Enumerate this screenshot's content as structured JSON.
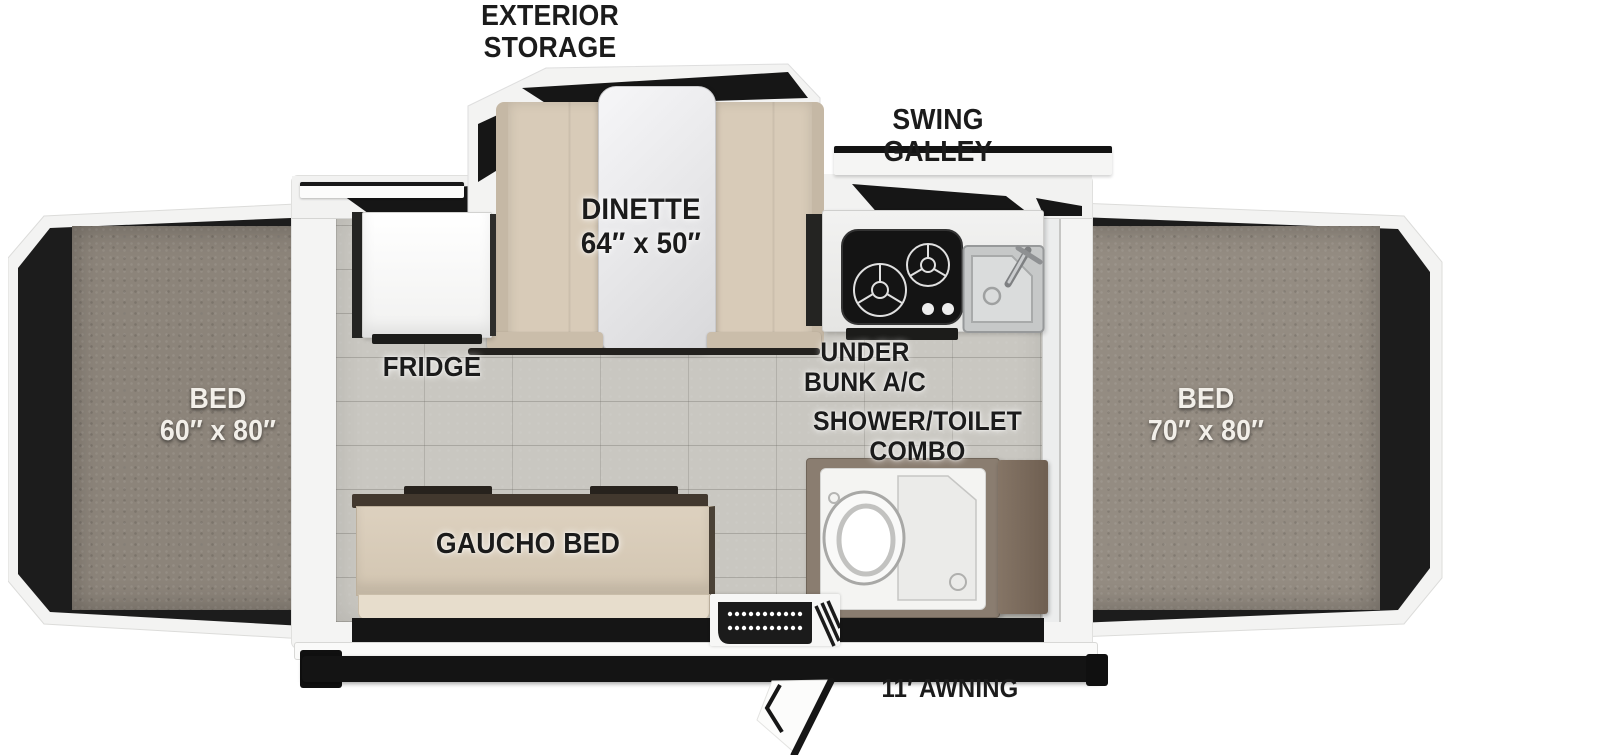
{
  "labels": {
    "exterior_storage": {
      "line1": "EXTERIOR",
      "line2": "STORAGE"
    },
    "swing_galley": {
      "line1": "SWING",
      "line2": "GALLEY"
    },
    "dinette": {
      "line1": "DINETTE",
      "line2": "64″ x 50″"
    },
    "fridge": {
      "text": "FRIDGE"
    },
    "under_bunk_ac": {
      "line1": "UNDER",
      "line2": "BUNK A/C"
    },
    "shower_toilet_combo": {
      "line1": "SHOWER/TOILET",
      "line2": "COMBO"
    },
    "bed_left": {
      "line1": "BED",
      "line2": "60″ x 80″"
    },
    "bed_right": {
      "line1": "BED",
      "line2": "70″ x 80″"
    },
    "gaucho_bed": {
      "text": "GAUCHO BED"
    },
    "awning": {
      "text": "11′ AWNING"
    }
  },
  "colors": {
    "label_text": "#1b1b1b",
    "bed_label_text": "#f2efe9",
    "carpet_left": "#8c847a",
    "carpet_right": "#948c82",
    "floor_tile": "#c9c7c1",
    "trailer_white": "#f4f4f3",
    "accent_black": "#151515",
    "bench_beige": "#d8cbb8",
    "sofa_beige": "#d9ccb9",
    "shower_frame_taupe": "#8a7d70",
    "cabinet_brown": "#7b6b5d"
  }
}
